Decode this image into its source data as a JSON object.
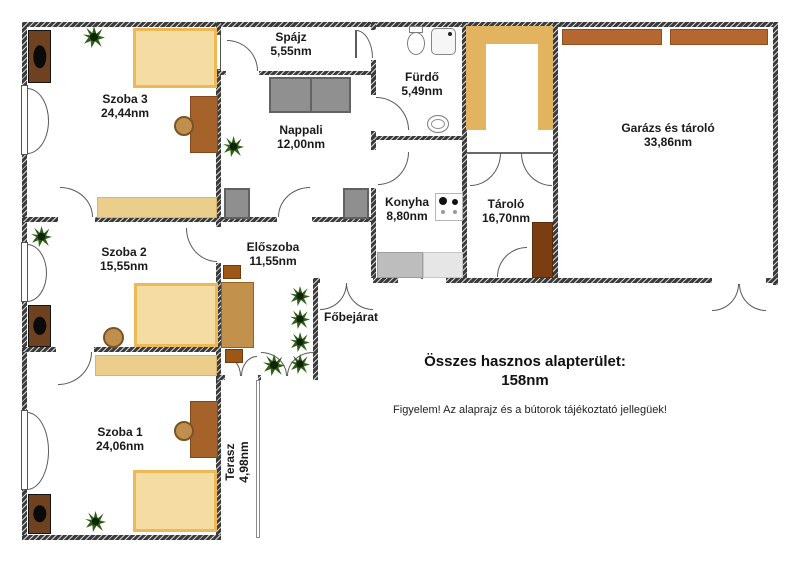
{
  "plan": {
    "rooms": [
      {
        "name": "Szoba 3",
        "area": "24,44nm"
      },
      {
        "name": "Spájz",
        "area": "5,55nm"
      },
      {
        "name": "Nappali",
        "area": "12,00nm"
      },
      {
        "name": "Fürdő",
        "area": "5,49nm"
      },
      {
        "name": "Konyha",
        "area": "8,80nm"
      },
      {
        "name": "Tároló",
        "area": "16,70nm"
      },
      {
        "name": "Garázs és tároló",
        "area": "33,86nm"
      },
      {
        "name": "Előszoba",
        "area": "11,55nm"
      },
      {
        "name": "Szoba 2",
        "area": "15,55nm"
      },
      {
        "name": "Szoba 1",
        "area": "24,06nm"
      },
      {
        "name": "Terasz",
        "area": "4,98nm"
      }
    ],
    "entrance_label": "Főbejárat",
    "summary_title": "Összes hasznos alapterület:",
    "summary_total": "158nm",
    "note": "Figyelem! Az alaprajz és a bútorok tájékoztató jellegüek!",
    "colors": {
      "wall": "#3b3b3b",
      "bed_fill": "#f4dca2",
      "bed_border": "#ecb858",
      "furniture_brown": "#a5622b",
      "wardrobe_brown": "#6e4120",
      "sofa_gray": "#909090",
      "plant_green": "#2f5e18",
      "storage_tan": "#e2b45f",
      "shelf_sienna": "#b4682f"
    }
  }
}
